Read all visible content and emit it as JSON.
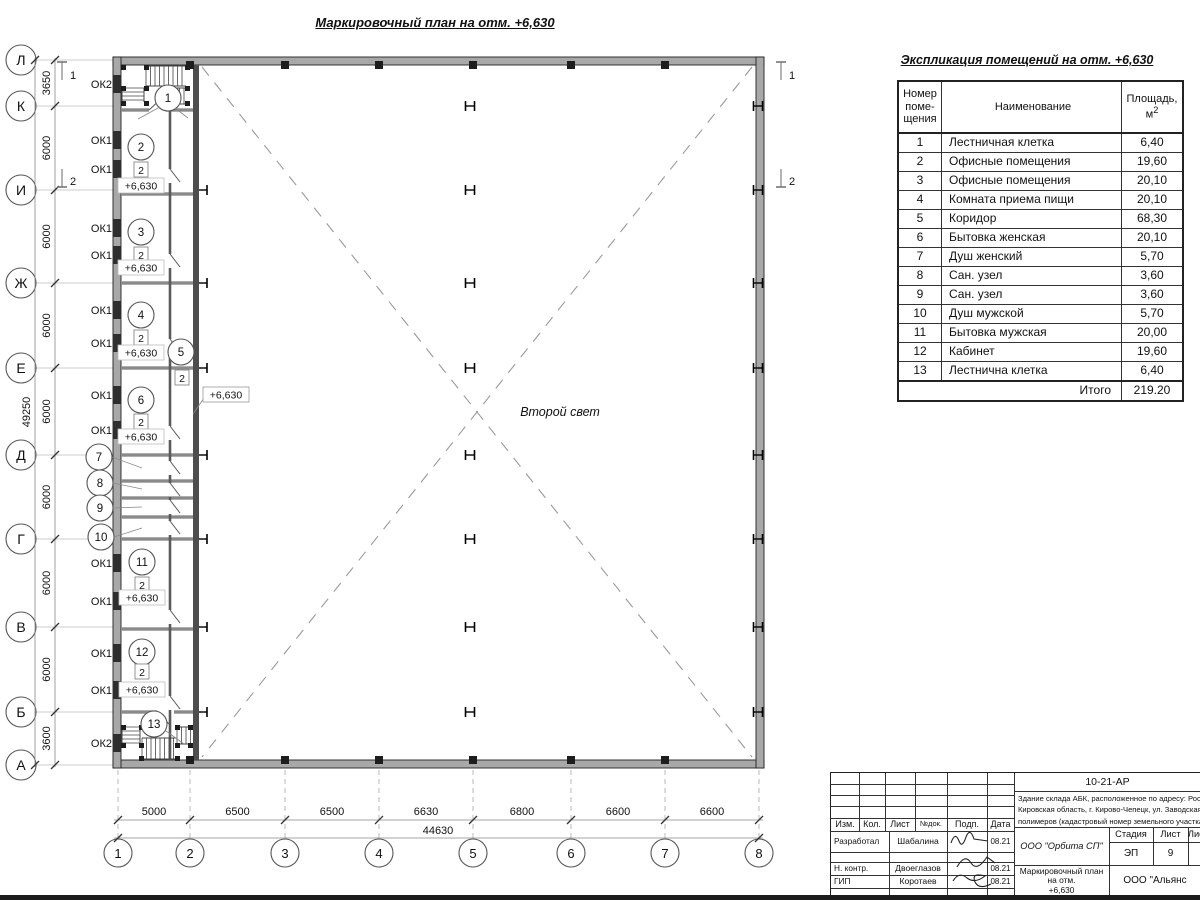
{
  "plan": {
    "title": "Маркировочный план на отм. +6,630",
    "row_axes": [
      "Л",
      "К",
      "И",
      "Ж",
      "Е",
      "Д",
      "Г",
      "В",
      "Б",
      "А"
    ],
    "col_axes": [
      "1",
      "2",
      "3",
      "4",
      "5",
      "6",
      "7",
      "8"
    ],
    "row_dims": [
      "3650",
      "6000",
      "6000",
      "6000",
      "6000",
      "6000",
      "6000",
      "6000",
      "3600"
    ],
    "row_total": "49250",
    "col_dims": [
      "5000",
      "6500",
      "6500",
      "6630",
      "6800",
      "6600",
      "6600"
    ],
    "col_total": "44630",
    "elevation_mark": "+6,630",
    "floor_type_mark": "2",
    "second_light_label": "Второй свет",
    "window_labels": {
      "ok1": "ОК1",
      "ok2": "ОК2"
    },
    "room_numbers": [
      "1",
      "2",
      "3",
      "4",
      "5",
      "6",
      "7",
      "8",
      "9",
      "10",
      "11",
      "12",
      "13"
    ],
    "section_marks": [
      "1",
      "2"
    ]
  },
  "schedule": {
    "title": "Экспликация помещений на отм. +6,630",
    "col_number": "Номер поме- щения",
    "col_name": "Наименование",
    "col_area_line1": "Площадь,",
    "col_area_m": "м",
    "col_area_sup": "2",
    "rows": [
      {
        "num": "1",
        "name": "Лестничная клетка",
        "area": "6,40"
      },
      {
        "num": "2",
        "name": "Офисные помещения",
        "area": "19,60"
      },
      {
        "num": "3",
        "name": "Офисные помещения",
        "area": "20,10"
      },
      {
        "num": "4",
        "name": "Комната приема пищи",
        "area": "20,10"
      },
      {
        "num": "5",
        "name": "Коридор",
        "area": "68,30"
      },
      {
        "num": "6",
        "name": "Бытовка женская",
        "area": "20,10"
      },
      {
        "num": "7",
        "name": "Душ женский",
        "area": "5,70"
      },
      {
        "num": "8",
        "name": "Сан. узел",
        "area": "3,60"
      },
      {
        "num": "9",
        "name": "Сан. узел",
        "area": "3,60"
      },
      {
        "num": "10",
        "name": "Душ мужской",
        "area": "5,70"
      },
      {
        "num": "11",
        "name": "Бытовка мужская",
        "area": "20,00"
      },
      {
        "num": "12",
        "name": "Кабинет",
        "area": "19,60"
      },
      {
        "num": "13",
        "name": "Лестнична клетка",
        "area": "6,40"
      }
    ],
    "total_label": "Итого",
    "total_value": "219.20"
  },
  "title_block": {
    "doc_number": "10-21-АР",
    "description_lines": [
      "Здание склада АБК, расположенное по адресу: Российская Феде",
      "Кировская область, г. Кирово-Чепецк, ул. Заводская, площадка з",
      "полимеров (кадастровый номер земельного участка 43:42:0000"
    ],
    "header_cols": [
      "Изм.",
      "Кол.",
      "Лист",
      "№док.",
      "Подп.",
      "Дата"
    ],
    "signers": [
      {
        "role": "Разработал",
        "name": "Шабалина",
        "date": "08.21"
      },
      {
        "role": "Н. контр.",
        "name": "Двоеглазов",
        "date": "08.21"
      },
      {
        "role": "ГИП",
        "name": "Коротаев",
        "date": "08.21"
      }
    ],
    "org": "ООО \"Орбита СП\"",
    "stage_label": "Стадия",
    "sheet_label": "Лист",
    "sheets_label": "Листов",
    "stage": "ЭП",
    "sheet": "9",
    "sheets": "1",
    "drawing_title_lines": [
      "Маркировочный план на отм.",
      "+6,630"
    ],
    "org2": "ООО \"Альянс"
  }
}
